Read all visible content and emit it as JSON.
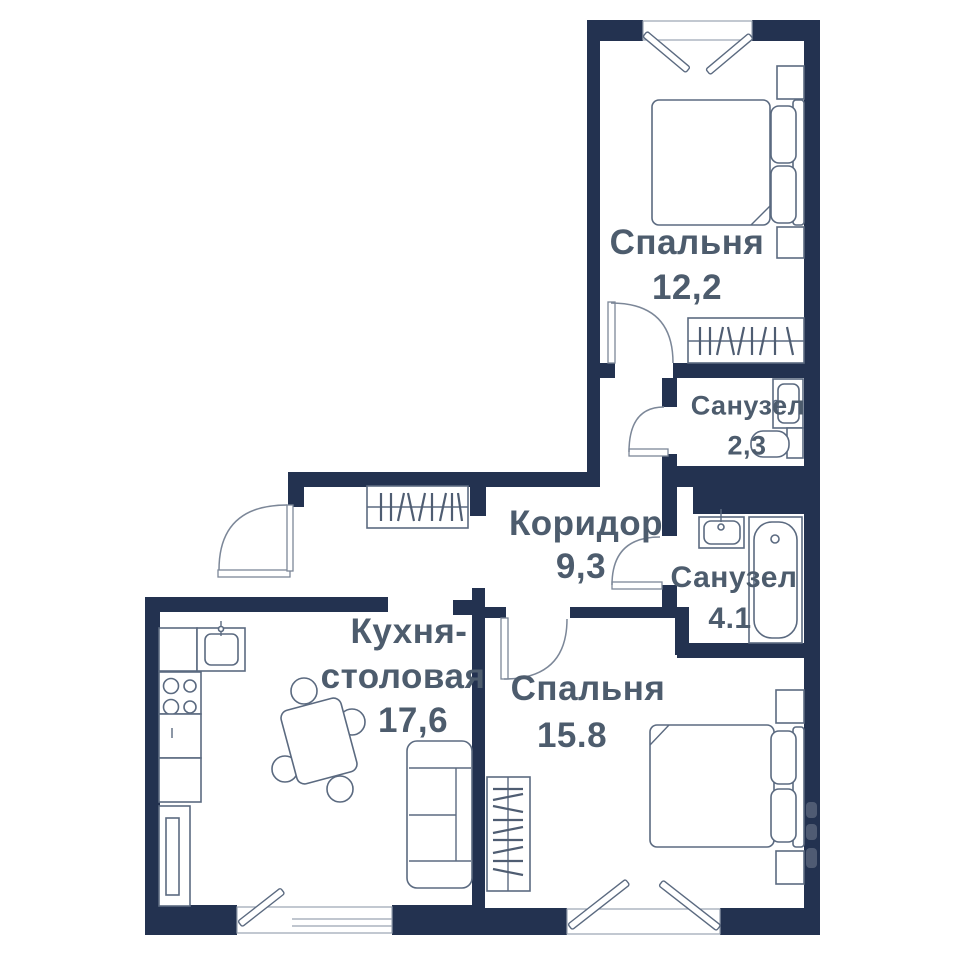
{
  "plan": {
    "title": "Apartment floor plan",
    "rooms": [
      {
        "id": "bedroom-1",
        "name": "Спальня",
        "area": "12,2"
      },
      {
        "id": "bathroom-1",
        "name": "Санузел",
        "area": "2,3"
      },
      {
        "id": "corridor",
        "name": "Коридор",
        "area": "9,3"
      },
      {
        "id": "bathroom-2",
        "name": "Санузел",
        "area": "4.1"
      },
      {
        "id": "kitchen",
        "name_line1": "Кухня-",
        "name_line2": "столовая",
        "area": "17,6"
      },
      {
        "id": "bedroom-2",
        "name": "Спальня",
        "area": "15.8"
      }
    ],
    "colors": {
      "wall": "#233250",
      "label": "#4d5c6d",
      "furniture": "#5b6a80"
    }
  }
}
